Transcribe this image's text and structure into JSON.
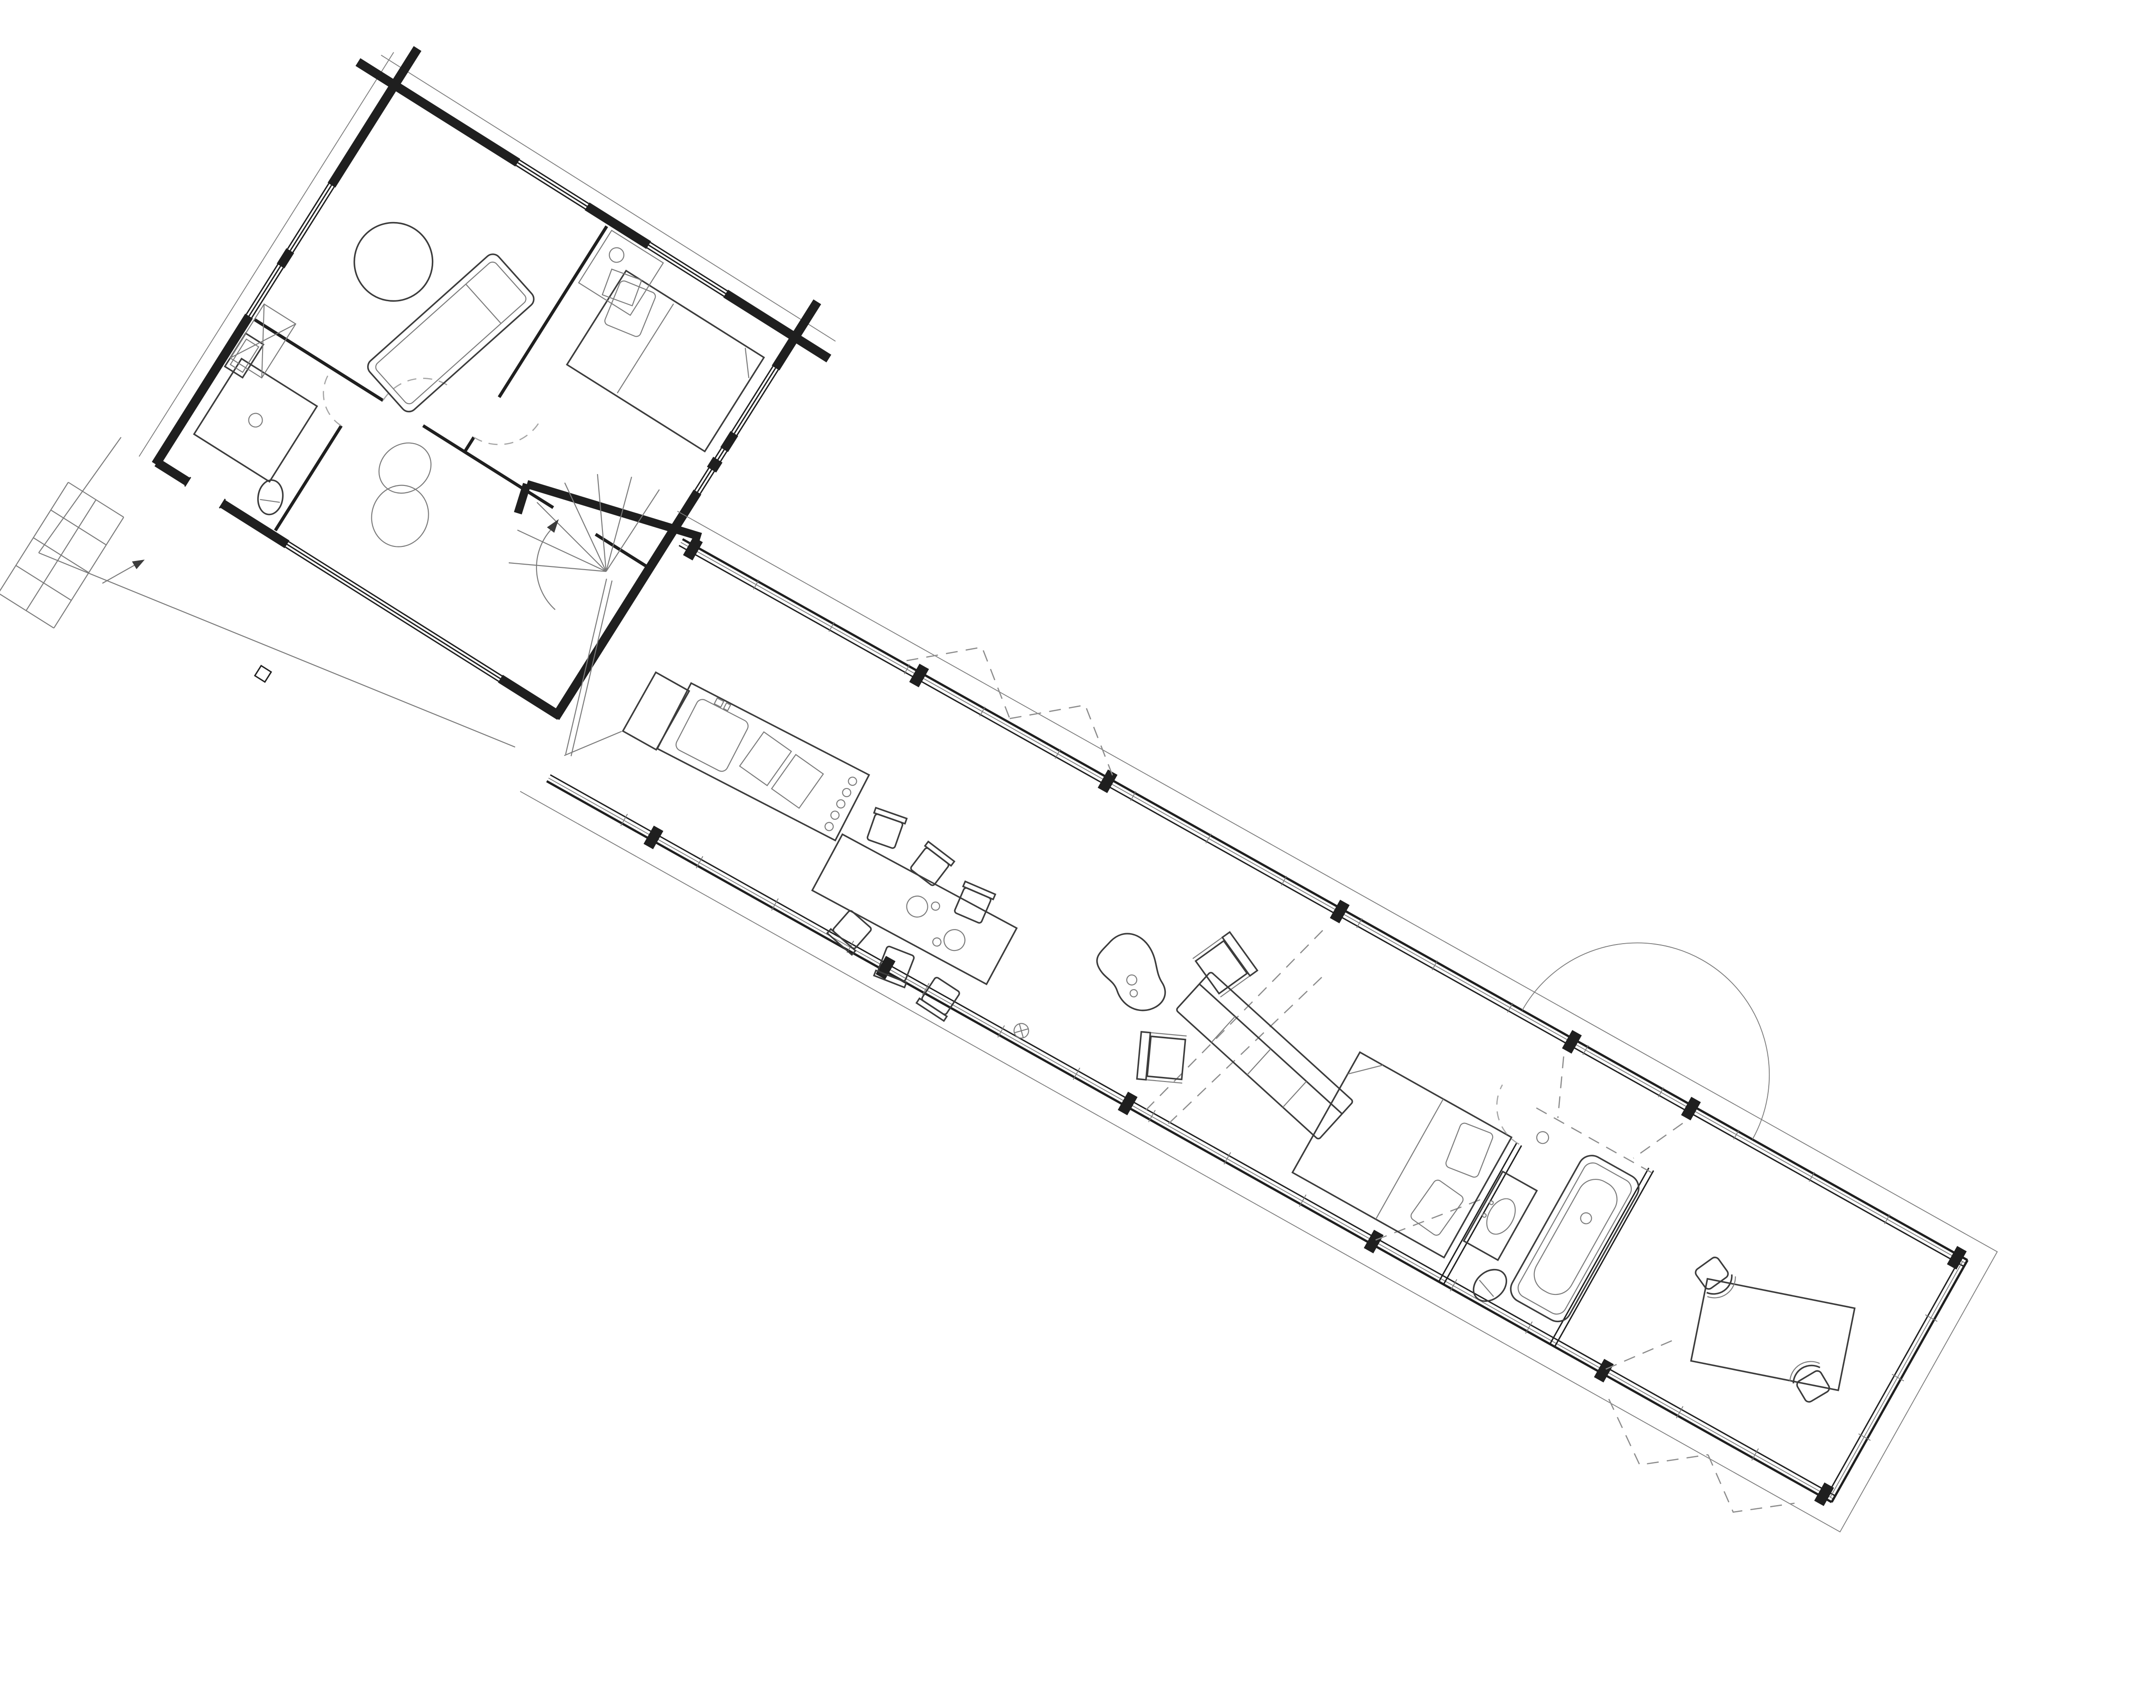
{
  "document": {
    "type": "architectural floor plan",
    "view": "top-down line drawing, single storey, no text labels visible",
    "composition": "small rotated log-cabin block at upper left joined by a winder stair to a long glazed pavilion wing running to the lower right; open deck terrace below the cabin"
  },
  "colors": {
    "paper": "#ffffff",
    "ink": "#1f1f1f",
    "mid": "#3c3c3c",
    "light": "#7a7a7a",
    "dash": "#8c8c8c",
    "arc": "#a5a5a5"
  },
  "cabin_block": {
    "construction": "log walls with crossed corner joints, window bands in every facade",
    "rooms": [
      {
        "name": "studio room",
        "furniture": [
          "round table",
          "daybed"
        ]
      },
      {
        "name": "cabin bedroom",
        "furniture": [
          "double bed",
          "tilted pillow",
          "closet counter with basin"
        ]
      },
      {
        "name": "cabin bathroom",
        "furniture": [
          "shower with floor drain",
          "washbasin",
          "toilet"
        ]
      },
      {
        "name": "hall",
        "furniture": [
          "figure-eight beanbag",
          "braced flue closet"
        ]
      }
    ],
    "openings": [
      "interior door arcs (dashed)",
      "entry door to deck with direction arrow"
    ],
    "exterior": [
      "entry tile grid",
      "deck terrace with edge post"
    ]
  },
  "wing": {
    "construction": "fully glazed long walls with mullion ticks and heavy black posts, roof overhang outline",
    "zones": [
      {
        "name": "stair junction",
        "furniture": [
          "winder staircase with curved arrow"
        ]
      },
      {
        "name": "kitchen",
        "furniture": [
          "island with sink, hob boards and knobs",
          "island return counter"
        ]
      },
      {
        "name": "dining",
        "furniture": [
          "long table",
          "six chairs",
          "two plates"
        ]
      },
      {
        "name": "living",
        "furniture": [
          "kidney coffee table",
          "two lounge chairs",
          "four-seat sofa",
          "floor gully"
        ]
      },
      {
        "name": "wing bedroom",
        "furniture": [
          "double bed with two pillows"
        ]
      },
      {
        "name": "wing bathroom",
        "furniture": [
          "vanity with oval basin",
          "bathtub with drain",
          "toilet"
        ]
      },
      {
        "name": "office",
        "furniture": [
          "desk",
          "two desk chairs"
        ]
      }
    ],
    "symbols": [
      "large outward door swing semicircle",
      "dashed opening triangles along facades",
      "dashed bathroom box diagonals"
    ]
  },
  "counts": {
    "dining_chairs": 6,
    "sofa_seat_divisions": 4,
    "lounge_chairs": 2,
    "stair_treads": 7,
    "entry_tiles": 8,
    "desk_chairs": 2,
    "heavy_posts_top_wall": 7,
    "heavy_posts_bottom_wall": 6
  }
}
